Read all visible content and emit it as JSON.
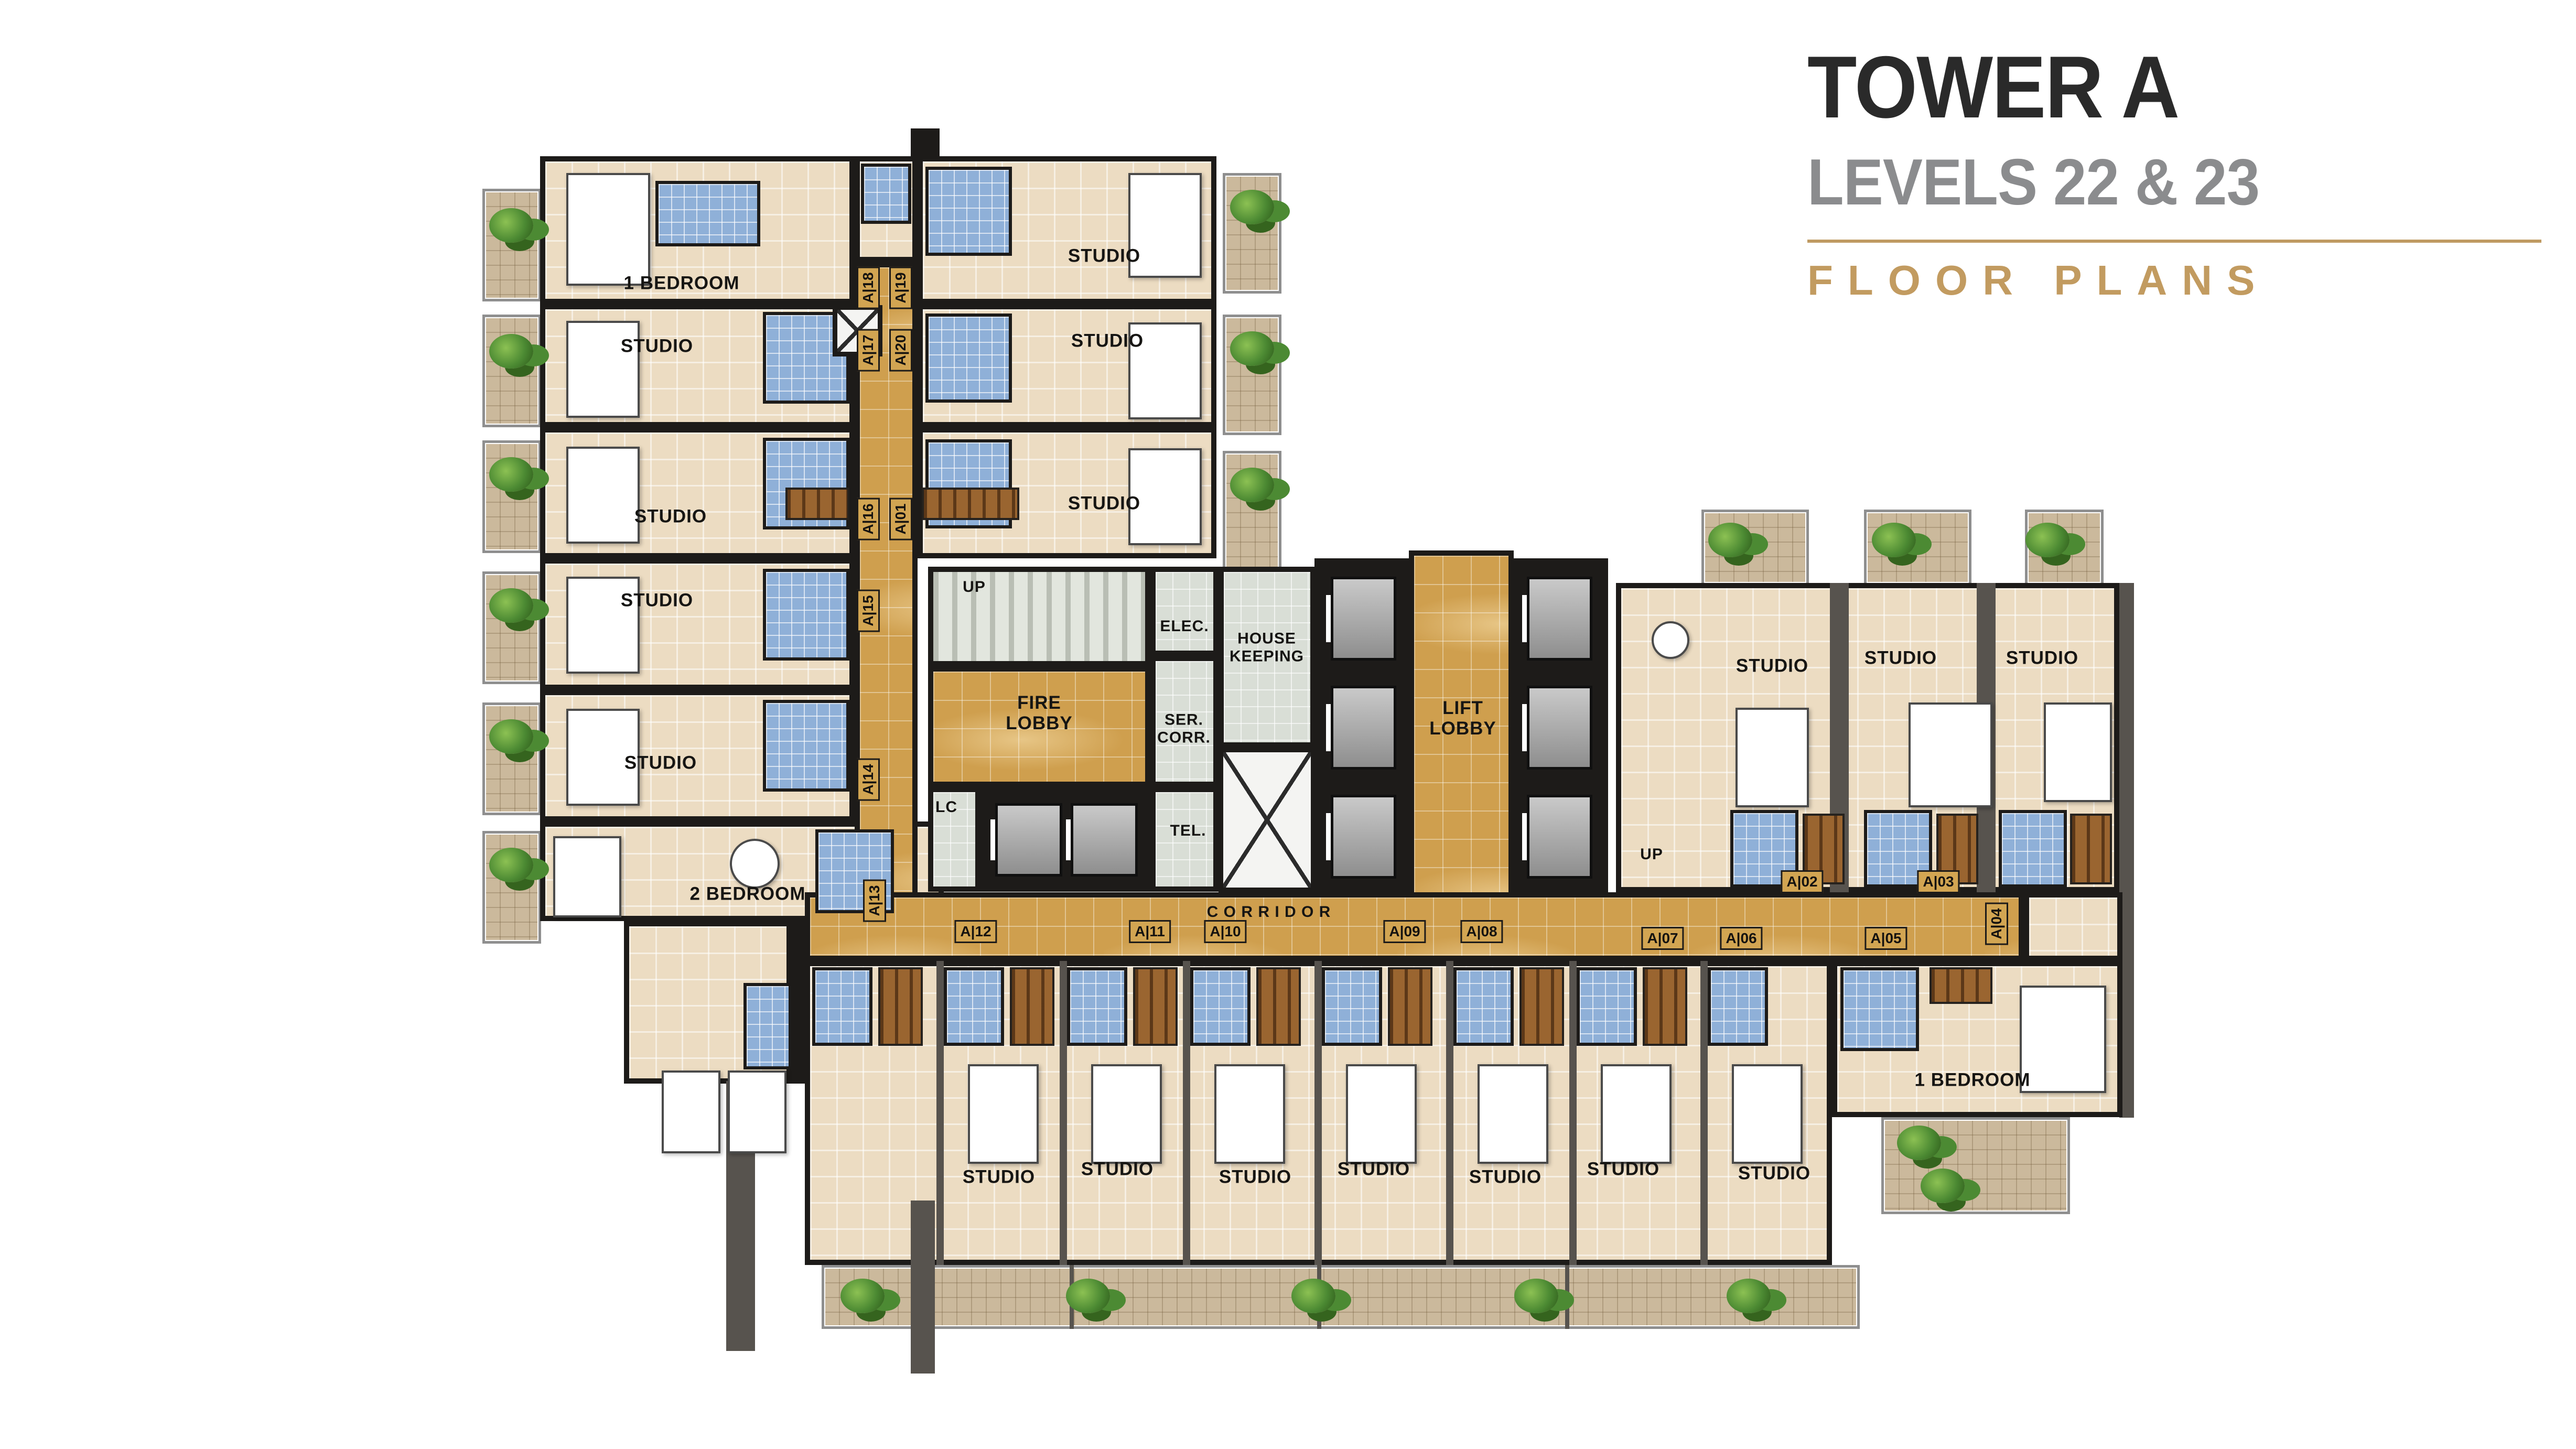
{
  "title_block": {
    "title": "TOWER A",
    "subtitle": "LEVELS 22 & 23",
    "section": "FLOOR PLANS"
  },
  "labels": {
    "studio": "STUDIO",
    "one_bedroom": "1 BEDROOM",
    "two_bedroom": "2 BEDROOM",
    "corridor": "C O R R I D O R",
    "fire_lobby": "FIRE\nLOBBY",
    "lift_lobby": "LIFT\nLOBBY",
    "housekeeping": "HOUSE\nKEEPING",
    "ser_corr": "SER.\nCORR.",
    "elec": "ELEC.",
    "tel": "TEL.",
    "lc": "LC",
    "up": "UP"
  },
  "unit_tags": {
    "t18": "A|18",
    "t19": "A|19",
    "t17": "A|17",
    "t20": "A|20",
    "t16": "A|16",
    "t01": "A|01",
    "t15": "A|15",
    "t14": "A|14",
    "t13": "A|13",
    "t12": "A|12",
    "t11": "A|11",
    "t10": "A|10",
    "t09": "A|09",
    "t08": "A|08",
    "t07": "A|07",
    "t06": "A|06",
    "t05": "A|05",
    "t04": "A|04",
    "t02": "A|02",
    "t03": "A|03"
  },
  "colors": {
    "corridor": "#cf9f4e",
    "unit_floor": "#ecdcc2",
    "bathroom": "#8fb0d8",
    "core_room": "#d9ded6",
    "balcony": "#cbb99c",
    "wall": "#1d1b19",
    "wall_gray": "#57534e",
    "wardrobe": "#9a6530",
    "plant": "#4c8a33",
    "accent_gold": "#c29b60",
    "subtitle_gray": "#8b8c8e",
    "title": "#2a2a2a"
  }
}
